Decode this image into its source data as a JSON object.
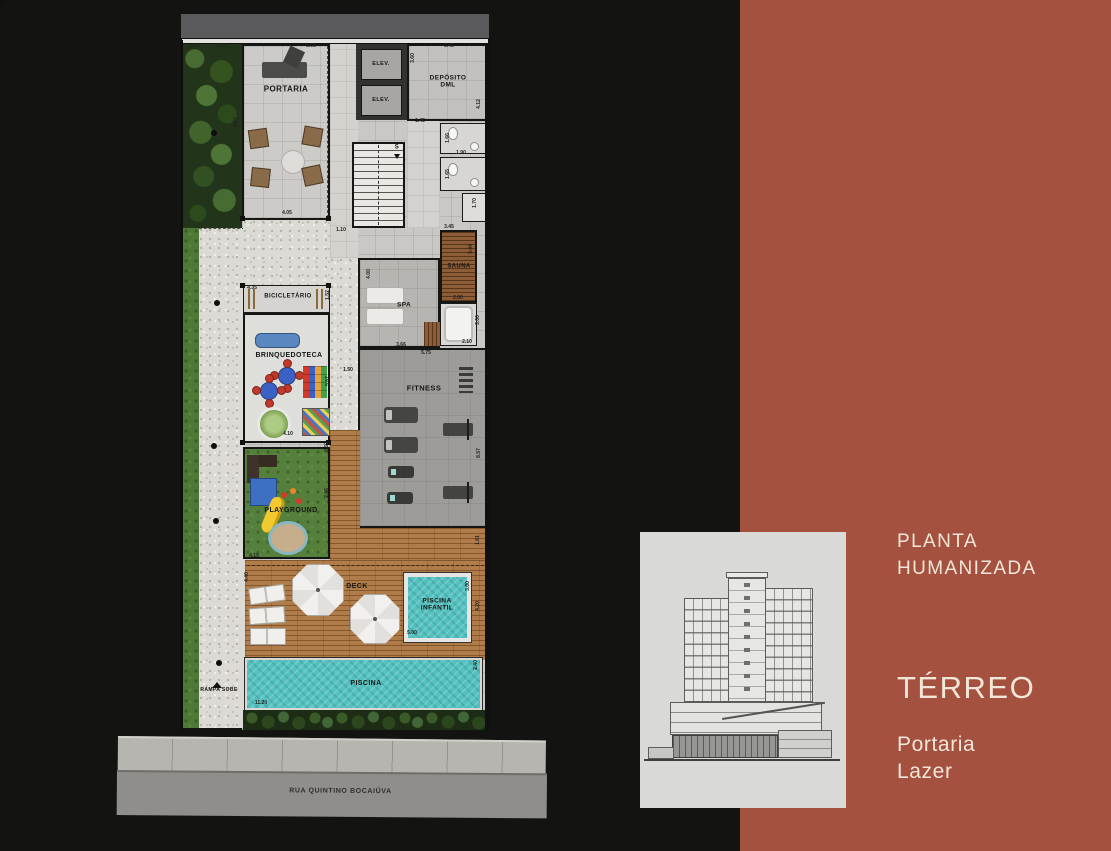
{
  "right_panel": {
    "title_line1": "PLANTA",
    "title_line2": "HUMANIZADA",
    "floor_title": "TÉRREO",
    "sub_items": [
      {
        "label": "Portaria"
      },
      {
        "label": "Lazer"
      }
    ]
  },
  "street": {
    "name": "RUA QUINTINO BOCAIÚVA"
  },
  "colors": {
    "background": "#131311",
    "accent_panel": "#a5513f",
    "text_cream": "#f2e6d8",
    "water": "#53c1bf",
    "deck_wood": "#b07d4a",
    "grass": "#4e7836"
  },
  "icons": [
    "reception-desk-icon",
    "lounge-set-icon",
    "elevator-icon",
    "stairs-icon",
    "toilet-icon",
    "spa-bed-icon",
    "sauna-bench-icon",
    "treadmill-icon",
    "exercise-bike-icon",
    "weight-bench-icon",
    "bike-rack-icon",
    "sofa-icon",
    "play-table-icon",
    "toy-blocks-icon",
    "rug-icon",
    "slide-icon",
    "sandbox-icon",
    "umbrella-icon",
    "sun-lounger-icon",
    "ramp-arrow-icon",
    "building-section-icon"
  ],
  "plan": {
    "room_labels": [
      {
        "t": "PORTARIA",
        "x": 286,
        "y": 89,
        "fs": 8
      },
      {
        "t": "ELEV.",
        "x": 381,
        "y": 64,
        "fs": 5.5
      },
      {
        "t": "ELEV.",
        "x": 381,
        "y": 100,
        "fs": 5.5
      },
      {
        "t": "DEPÓSITO\nDML",
        "x": 448,
        "y": 82,
        "fs": 6.5
      },
      {
        "t": "S",
        "x": 397,
        "y": 148,
        "fs": 6
      },
      {
        "t": "SAUNA",
        "x": 459,
        "y": 267,
        "fs": 6
      },
      {
        "t": "SPA",
        "x": 404,
        "y": 305,
        "fs": 6.5
      },
      {
        "t": "FITNESS",
        "x": 424,
        "y": 389,
        "fs": 7.5
      },
      {
        "t": "BICICLETÁRIO",
        "x": 288,
        "y": 297,
        "fs": 6
      },
      {
        "t": "BRINQUEDOTECA",
        "x": 289,
        "y": 356,
        "fs": 7
      },
      {
        "t": "PLAYGROUND",
        "x": 291,
        "y": 511,
        "fs": 7
      },
      {
        "t": "DECK",
        "x": 357,
        "y": 587,
        "fs": 7
      },
      {
        "t": "PISCINA\nINFANTIL",
        "x": 437,
        "y": 605,
        "fs": 6.5
      },
      {
        "t": "PISCINA",
        "x": 366,
        "y": 684,
        "fs": 7
      },
      {
        "t": "RAMPA SOBE",
        "x": 219,
        "y": 691,
        "fs": 5
      }
    ],
    "dim_labels": [
      {
        "t": "1.17",
        "x": 193,
        "y": 46
      },
      {
        "t": "1.65",
        "x": 221,
        "y": 46
      },
      {
        "t": "5.05",
        "x": 311,
        "y": 46
      },
      {
        "t": "3.45",
        "x": 449,
        "y": 46
      },
      {
        "t": "3.60",
        "x": 413,
        "y": 58,
        "r": -90
      },
      {
        "t": "4.12",
        "x": 479,
        "y": 104,
        "r": -90
      },
      {
        "t": "1.45",
        "x": 420,
        "y": 121
      },
      {
        "t": "6.57",
        "x": 236,
        "y": 122,
        "r": -90
      },
      {
        "t": "1.66",
        "x": 448,
        "y": 138,
        "r": -90
      },
      {
        "t": "1.90",
        "x": 461,
        "y": 153
      },
      {
        "t": "1.65",
        "x": 448,
        "y": 174,
        "r": -90
      },
      {
        "t": "1.70",
        "x": 475,
        "y": 203,
        "r": -90
      },
      {
        "t": "4.05",
        "x": 287,
        "y": 213
      },
      {
        "t": "1.10",
        "x": 341,
        "y": 230
      },
      {
        "t": "3.45",
        "x": 449,
        "y": 227
      },
      {
        "t": "3.44",
        "x": 471,
        "y": 249,
        "r": -90
      },
      {
        "t": "4.00",
        "x": 369,
        "y": 274,
        "r": -90
      },
      {
        "t": "2.00",
        "x": 458,
        "y": 298
      },
      {
        "t": "3.00",
        "x": 478,
        "y": 320,
        "r": -90
      },
      {
        "t": "3.66",
        "x": 401,
        "y": 345
      },
      {
        "t": "2.10",
        "x": 467,
        "y": 342
      },
      {
        "t": "5.75",
        "x": 426,
        "y": 353
      },
      {
        "t": "4.35",
        "x": 252,
        "y": 288
      },
      {
        "t": "1.52",
        "x": 328,
        "y": 295,
        "r": -90
      },
      {
        "t": "1.50",
        "x": 348,
        "y": 370
      },
      {
        "t": "5.67",
        "x": 328,
        "y": 381,
        "r": -90
      },
      {
        "t": "4.10",
        "x": 288,
        "y": 434
      },
      {
        "t": "0.60",
        "x": 327,
        "y": 447,
        "r": -90
      },
      {
        "t": "2.46",
        "x": 327,
        "y": 493,
        "r": -90
      },
      {
        "t": "8.57",
        "x": 479,
        "y": 453,
        "r": -90
      },
      {
        "t": "4.15",
        "x": 254,
        "y": 556
      },
      {
        "t": "4.40",
        "x": 247,
        "y": 577,
        "r": -90
      },
      {
        "t": "1.61",
        "x": 478,
        "y": 540,
        "r": -90
      },
      {
        "t": "3.00",
        "x": 468,
        "y": 586,
        "r": -90
      },
      {
        "t": "4.20",
        "x": 478,
        "y": 606,
        "r": -90
      },
      {
        "t": "5.00",
        "x": 412,
        "y": 633
      },
      {
        "t": "2.40",
        "x": 476,
        "y": 665,
        "r": -90
      },
      {
        "t": "11.20",
        "x": 261,
        "y": 703
      }
    ]
  }
}
